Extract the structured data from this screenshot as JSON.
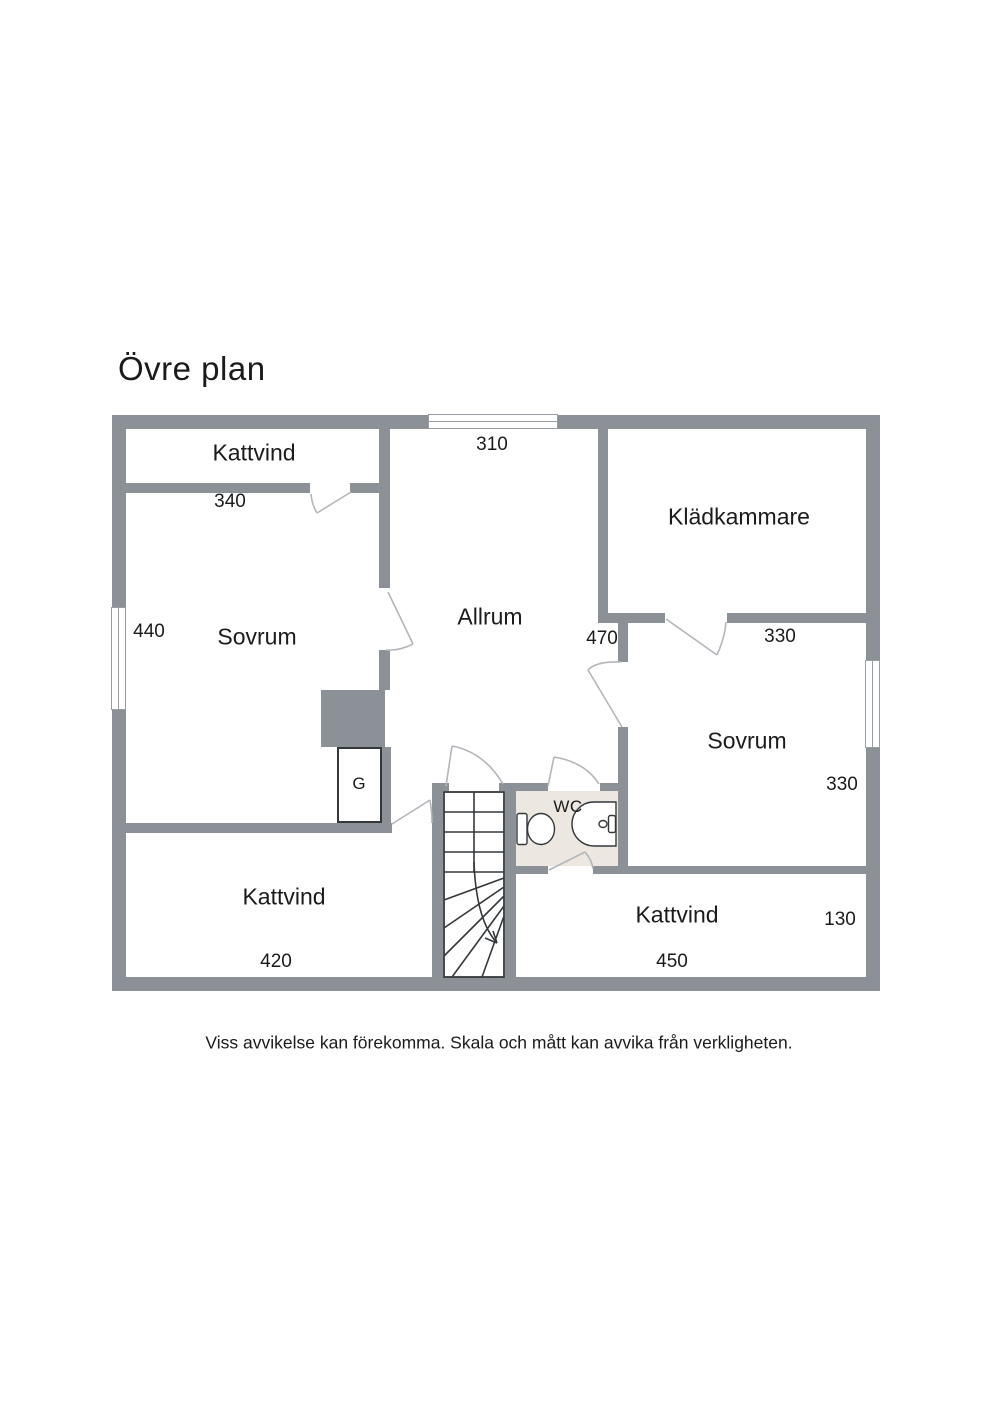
{
  "title": "Övre plan",
  "plan": {
    "rooms": {
      "kattvind_top": {
        "label": "Kattvind",
        "dim": "340"
      },
      "sovrum_left": {
        "label": "Sovrum",
        "dim_window": "440"
      },
      "allrum": {
        "label": "Allrum",
        "dim_window": "310"
      },
      "kladkammare": {
        "label": "Klädkammare",
        "dim": "330"
      },
      "hall": {
        "dim": "470"
      },
      "sovrum_right": {
        "label": "Sovrum",
        "dim_window": "330"
      },
      "kattvind_bottom_left": {
        "label": "Kattvind",
        "dim": "420"
      },
      "kattvind_bottom_right": {
        "label": "Kattvind",
        "dim": "450",
        "dim_depth": "130"
      },
      "wc": {
        "label": "WC"
      },
      "wardrobe": {
        "label": "G"
      }
    }
  },
  "footer": {
    "disclaimer": "Viss avvikelse kan förekomma. Skala och mått kan avvika från verkligheten."
  },
  "colors": {
    "wall": "#8b9196",
    "wc_floor": "#ece8e1",
    "outline": "#35383b",
    "door": "#b3b6ba",
    "window_frame": "#979da2",
    "text": "#1b1b1b"
  }
}
